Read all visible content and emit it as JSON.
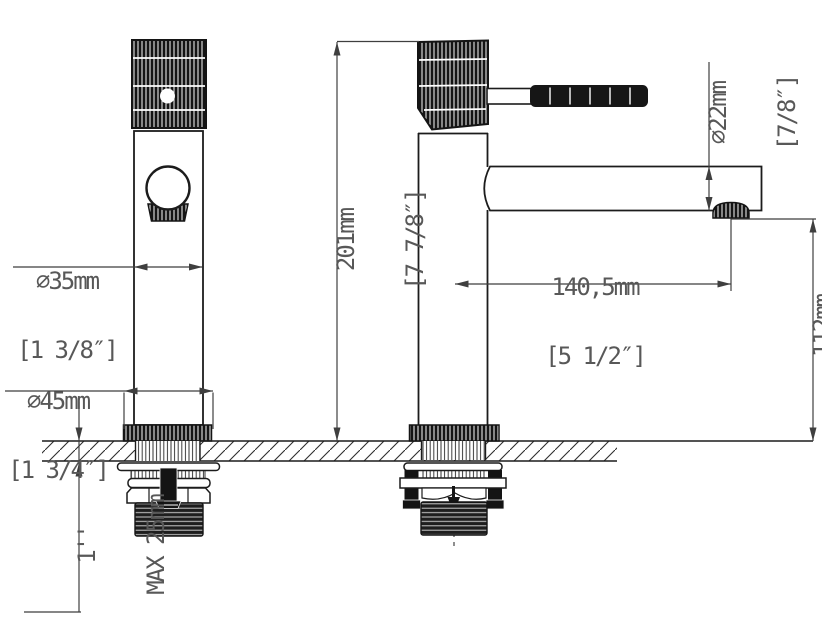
{
  "drawing": {
    "type": "technical-drawing",
    "subject": "single-lever basin faucet, front and side views with mounting hardware",
    "colors": {
      "background": "#ffffff",
      "outline": "#1c1c1c",
      "dimension_lines": "#3f3f3f",
      "dimension_text": "#585858"
    }
  },
  "dimensions": {
    "body_diameter": {
      "metric": "∅35mm",
      "imperial": "[1 3/8″]"
    },
    "base_diameter": {
      "metric": "∅45mm",
      "imperial": "[1 3/4″]"
    },
    "total_height": {
      "metric": "201mm",
      "imperial": "[7 7/8″]"
    },
    "spout_diameter": {
      "metric": "∅22mm",
      "imperial": "[7/8″]"
    },
    "spout_reach": {
      "metric": "140,5mm",
      "imperial": "[5 1/2″]"
    },
    "spout_height": {
      "metric": "112mm",
      "imperial": "[4 3/8″]"
    },
    "deck_thickness": {
      "imperial": "1''",
      "metric": "MAX 25mm"
    }
  }
}
